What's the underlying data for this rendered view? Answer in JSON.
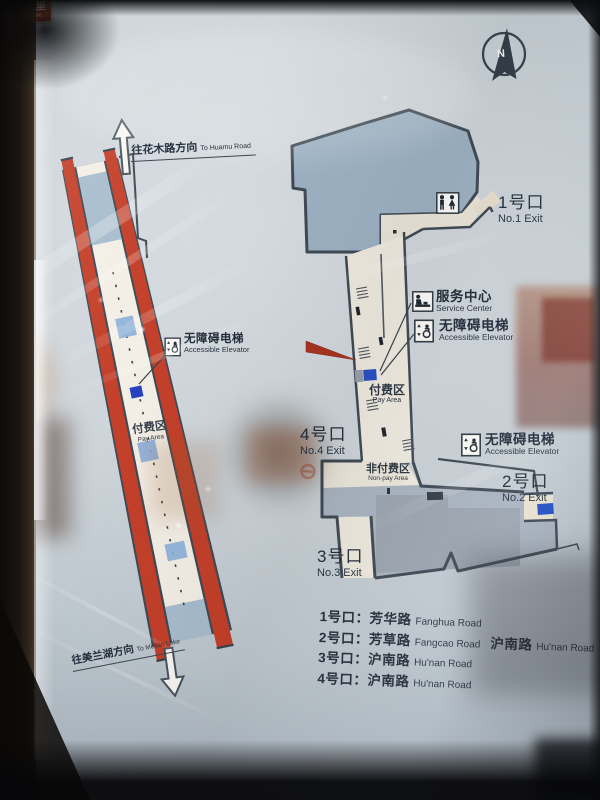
{
  "compass": {
    "label": "N"
  },
  "directions": {
    "huamu": {
      "zh": "往花木路方向",
      "en": "To Huamu Road"
    },
    "meilan": {
      "zh": "往美兰湖方向",
      "en": "To Meilan Lake"
    }
  },
  "platform": {
    "elevator": {
      "zh": "无障碍电梯",
      "en": "Accessible Elevator"
    },
    "pay_area": {
      "zh": "付费区",
      "en": "Pay Area"
    }
  },
  "concourse": {
    "service_center": {
      "zh": "服务中心",
      "en": "Service Center"
    },
    "elevator_mid": {
      "zh": "无障碍电梯",
      "en": "Accessible Elevator"
    },
    "elevator_east": {
      "zh": "无障碍电梯",
      "en": "Accessible Elevator"
    },
    "pay_area": {
      "zh": "付费区",
      "en": "Pay Area"
    },
    "non_pay_area": {
      "zh": "非付费区",
      "en": "Non-pay Area"
    },
    "you_are_here": {
      "zh": "您在这里",
      "en": "You are here"
    },
    "exit1": {
      "zh": "1号口",
      "en": "No.1 Exit"
    },
    "exit2": {
      "zh": "2号口",
      "en": "No.2 Exit"
    },
    "exit3": {
      "zh": "3号口",
      "en": "No.3 Exit"
    },
    "exit4": {
      "zh": "4号口",
      "en": "No.4 Exit"
    }
  },
  "legend": {
    "rows": [
      {
        "exit": "1号口：",
        "road1_zh": "芳华路",
        "road1_en": "Fanghua Road",
        "road2_zh": "",
        "road2_en": ""
      },
      {
        "exit": "2号口：",
        "road1_zh": "芳草路",
        "road1_en": "Fangcao Road",
        "road2_zh": "沪南路",
        "road2_en": "Hu'nan Road"
      },
      {
        "exit": "3号口：",
        "road1_zh": "沪南路",
        "road1_en": "Hu'nan Road",
        "road2_zh": "",
        "road2_en": ""
      },
      {
        "exit": "4号口：",
        "road1_zh": "沪南路",
        "road1_en": "Hu'nan Road",
        "road2_zh": "",
        "road2_en": ""
      }
    ]
  },
  "colors": {
    "track_red": "#c4402a",
    "concourse_blue": "#9db2c4",
    "hall_blue": "#a9b4c1",
    "corridor_beige": "#f0ebe0",
    "wall": "#404a55",
    "escalator_blue": "#8bafd9",
    "elevator_blue": "#2742c0",
    "callout_red": "#9c3520",
    "text": "#232d3b"
  }
}
